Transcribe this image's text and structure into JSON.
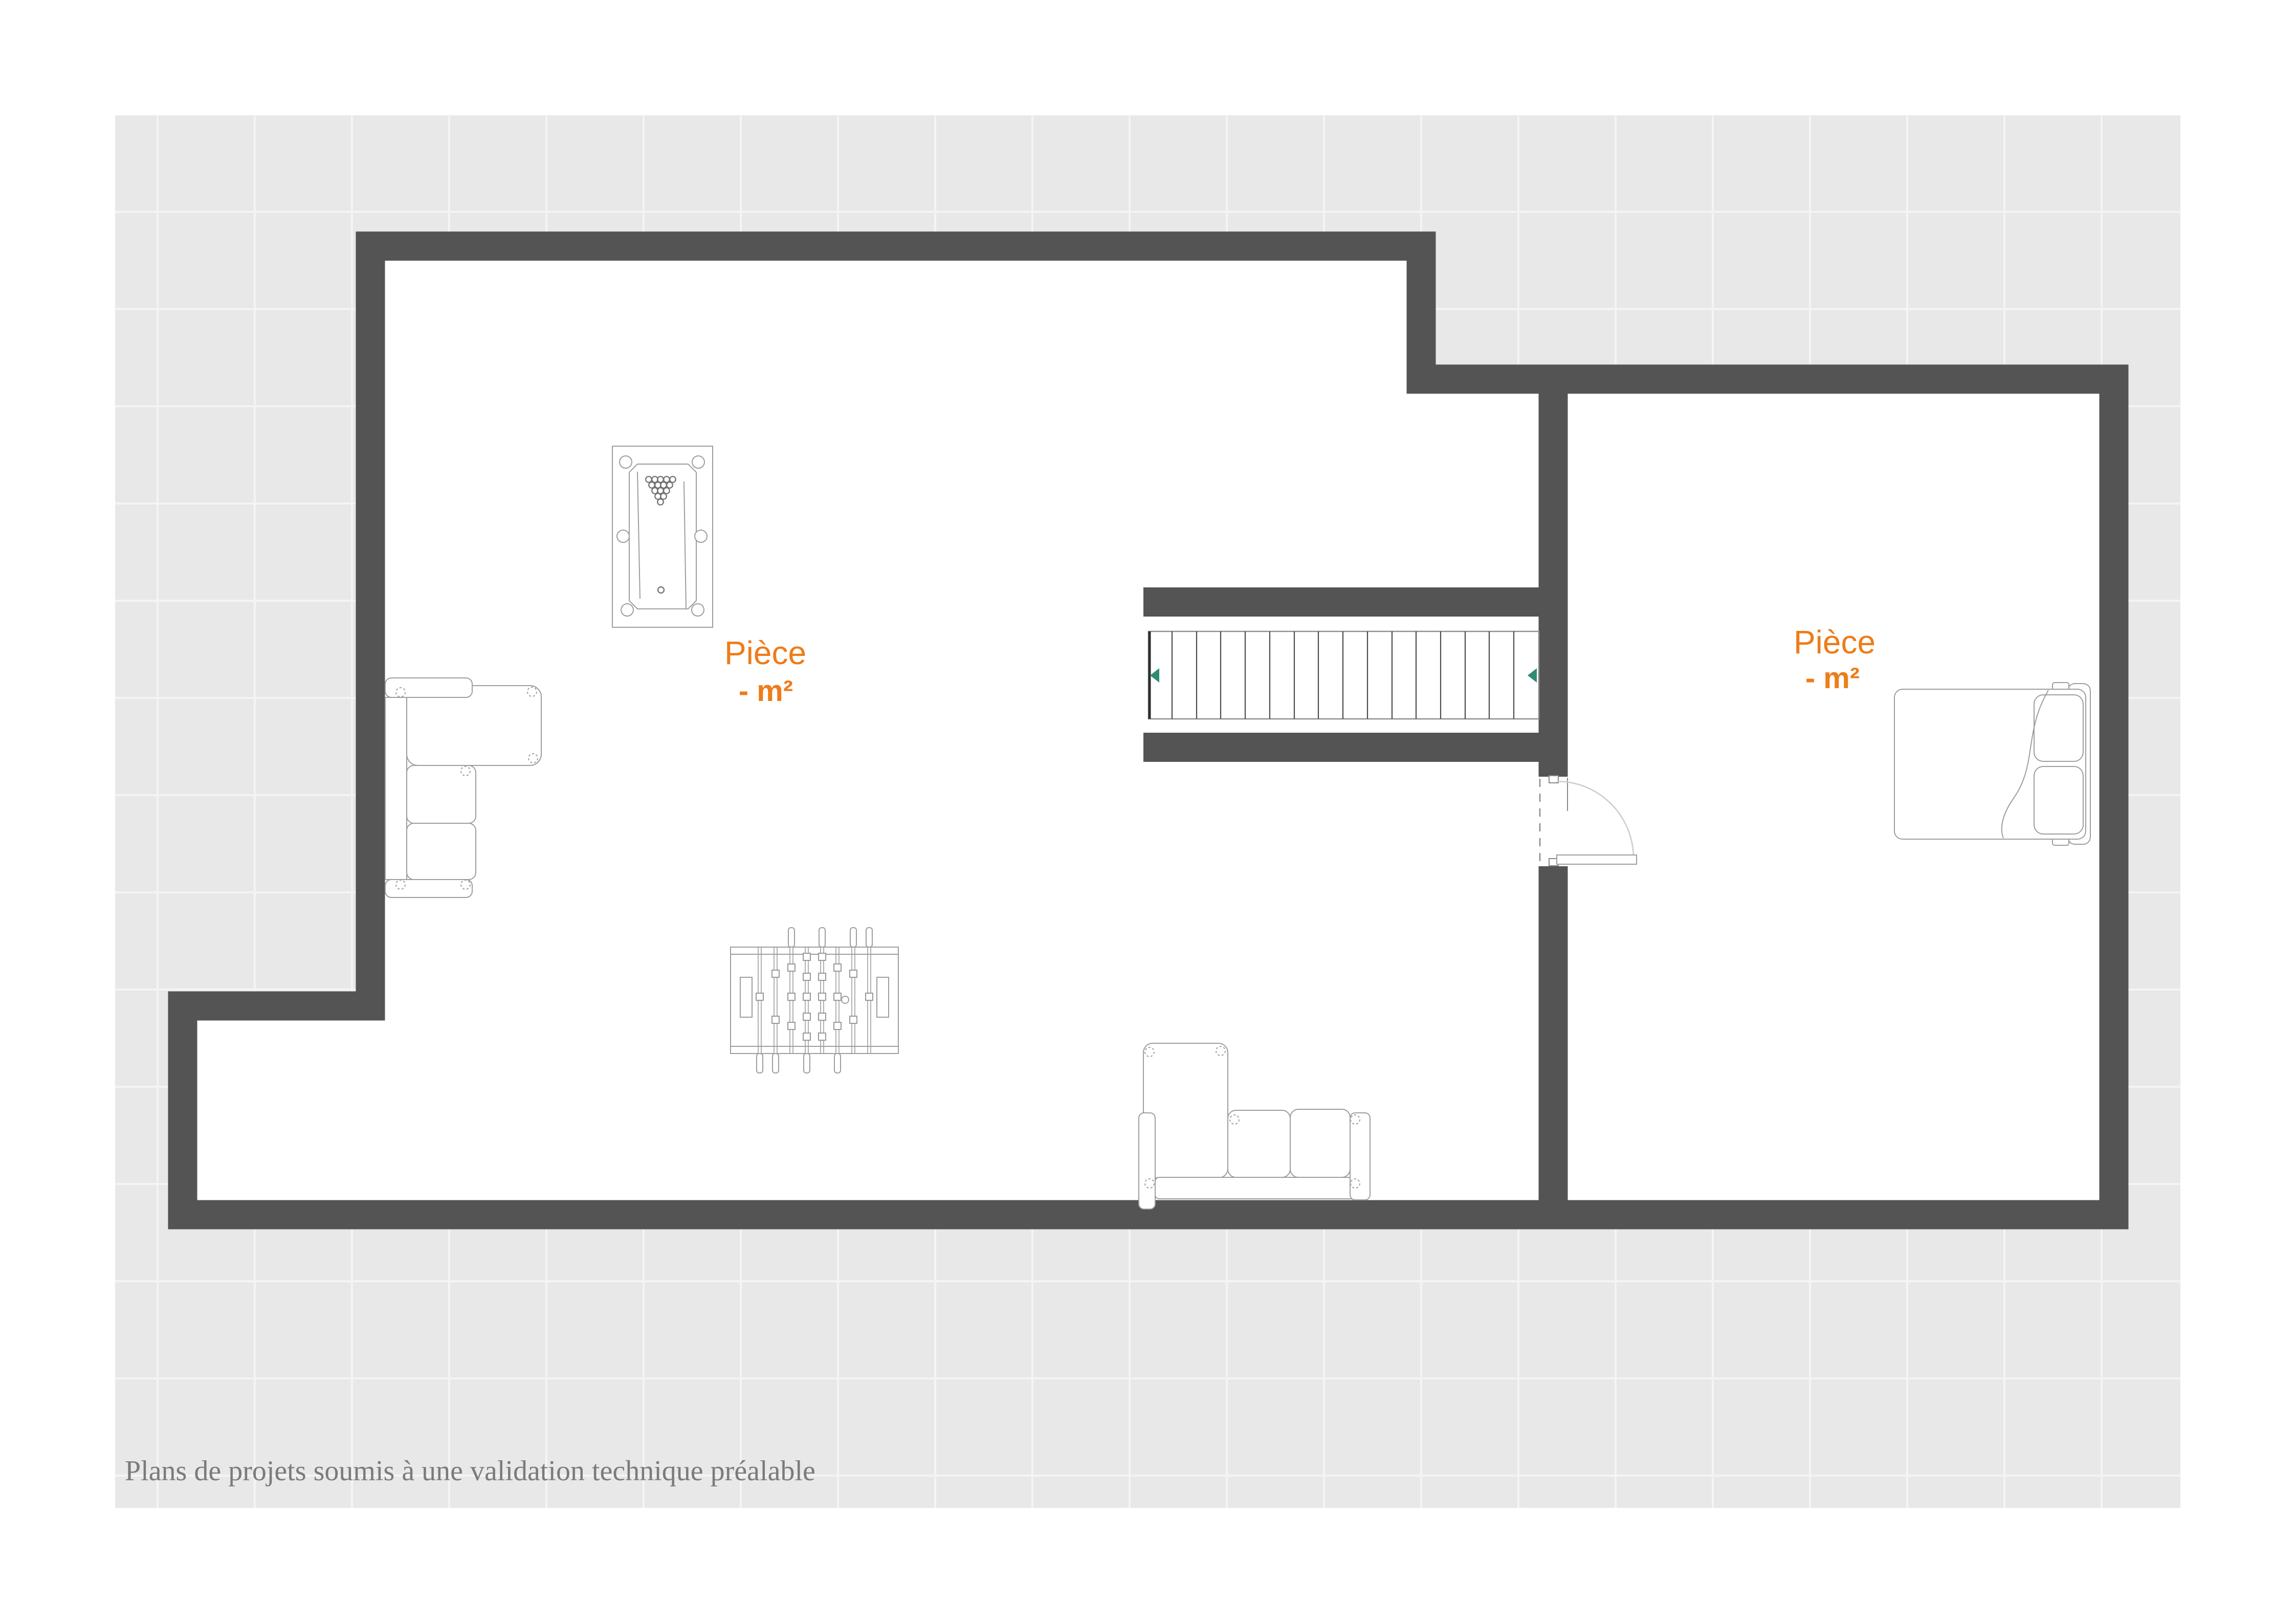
{
  "plan": {
    "rooms": [
      {
        "name": "Pièce",
        "area_label": "- m²"
      },
      {
        "name": "Pièce",
        "area_label": "- m²"
      }
    ],
    "furniture_icons": [
      "billiard-table-icon",
      "corner-sofa-icon",
      "foosball-table-icon",
      "sofa-icon",
      "staircase-icon",
      "stair-direction-arrow-icon",
      "door-icon",
      "double-bed-icon"
    ]
  },
  "footer": {
    "disclaimer": "Plans de projets soumis à une validation technique préalable"
  },
  "colors": {
    "page_background": "#ffffff",
    "canvas_background": "#e8e8e8",
    "grid_line": "#f4f4f4",
    "wall": "#545454",
    "furniture_line": "#9e9e9e",
    "accent_orange": "#ee7c18",
    "stair_arrow": "#2f8b72",
    "door_arc": "#cccccc",
    "footer_text": "#7b7b7b"
  }
}
